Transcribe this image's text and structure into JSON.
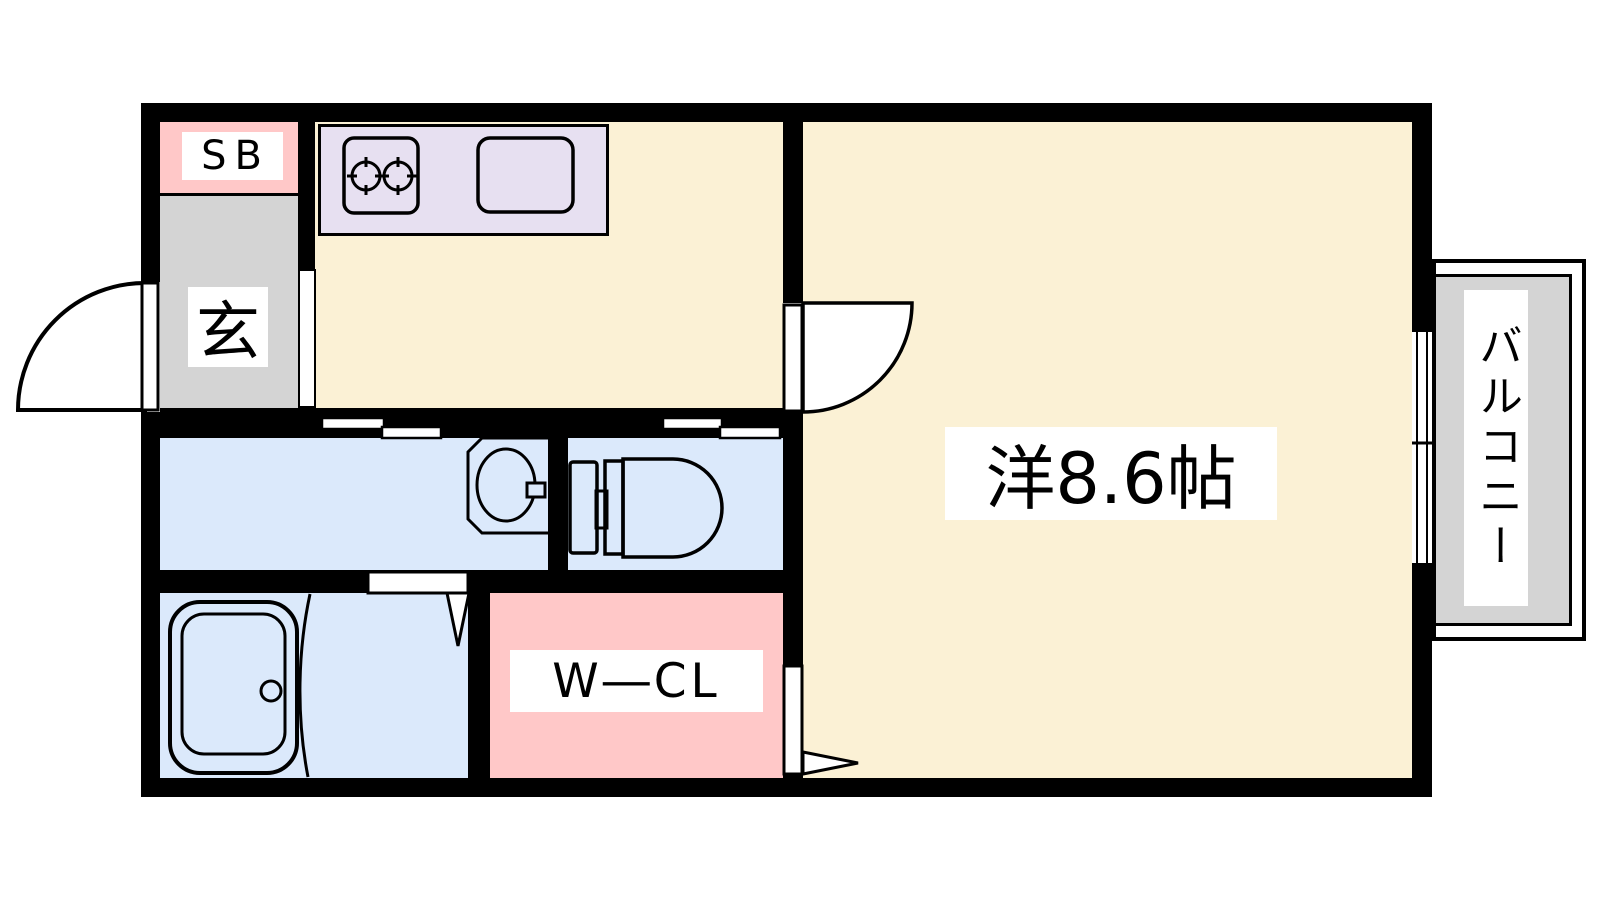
{
  "page": {
    "type": "apartment floor plan",
    "background": "#FFFFFF"
  },
  "colors": {
    "wall": "#000000",
    "floor_cream": "#FBF1D5",
    "kitchen_counter_purple": "#E7E0F1",
    "pink": "#FFC8C8",
    "gray": "#D4D4D4",
    "wet_area_blue": "#DBE9FB",
    "label_bg": "#FFFFFF",
    "line": "#000000"
  },
  "rooms": {
    "shoe_box": {
      "label": "SB",
      "color": "#FFC8C8"
    },
    "entrance": {
      "label": "玄",
      "color": "#D4D4D4"
    },
    "kitchen": {
      "color": "#FBF1D5"
    },
    "kitchen_counter": {
      "color": "#E7E0F1"
    },
    "main_room": {
      "label": "洋8.6帖",
      "color": "#FBF1D5"
    },
    "washroom": {
      "color": "#DBE9FB"
    },
    "toilet_room": {
      "color": "#DBE9FB"
    },
    "bathroom": {
      "color": "#DBE9FB"
    },
    "walk_in_closet": {
      "label": "W―CL",
      "color": "#FFC8C8"
    },
    "balcony": {
      "label": "バルコニー",
      "color": "#D4D4D4"
    }
  },
  "icons": {
    "stove": "two-burner-stove-icon",
    "kitchen_sink": "kitchen-sink-icon",
    "bathtub": "bathtub-icon",
    "washbasin": "washbasin-icon",
    "toilet": "toilet-icon",
    "entrance_door": "hinged-door-arc-icon",
    "room_door": "hinged-door-arc-icon",
    "closet_door": "folding-door-icon",
    "bathroom_door": "folding-door-icon",
    "sliding_doors": "sliding-door-icon",
    "balcony_window": "sliding-window-icon"
  }
}
